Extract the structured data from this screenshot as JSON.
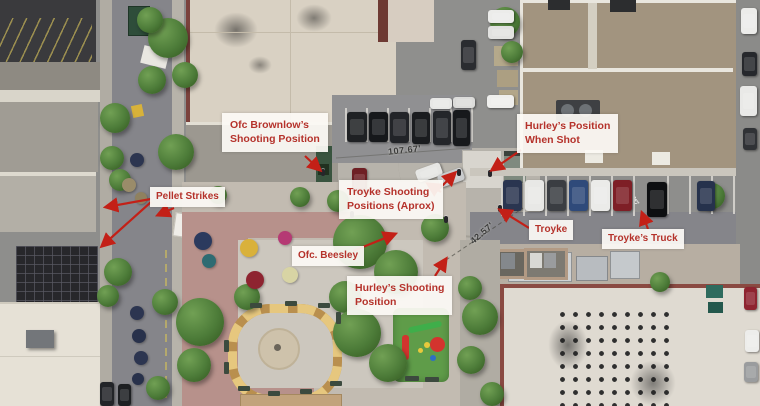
{
  "scene": {
    "kind": "aerial-drone-photo",
    "description": "Overhead view of a downtown block: streets, rooftops, central plaza with fountain, parking lots, playground"
  },
  "colors": {
    "annotation_text_red": "#b5322b",
    "arrow_red": "#c32017",
    "label_background": "rgba(252,250,245,0.93)",
    "measurement_text": "#3b3b3b"
  },
  "annotations": [
    {
      "id": "brownlow",
      "lines": [
        "Ofc Brownlow’s",
        "Shooting Position"
      ]
    },
    {
      "id": "pellet-strikes",
      "lines": [
        "Pellet Strikes"
      ]
    },
    {
      "id": "troyke-positions",
      "lines": [
        "Troyke Shooting",
        "Positions (Aprox)"
      ]
    },
    {
      "id": "hurley-when-shot",
      "lines": [
        "Hurley’s Position",
        "When Shot"
      ]
    },
    {
      "id": "troyke",
      "lines": [
        "Troyke"
      ]
    },
    {
      "id": "troykes-truck",
      "lines": [
        "Troyke’s Truck"
      ]
    },
    {
      "id": "beesley",
      "lines": [
        "Ofc. Beesley"
      ]
    },
    {
      "id": "hurley-shooting",
      "lines": [
        "Hurley’s Shooting",
        "Position"
      ]
    }
  ],
  "measurements": [
    {
      "id": "dist-107",
      "text": "107.67'"
    },
    {
      "id": "dist-42",
      "text": "42.57'"
    }
  ]
}
